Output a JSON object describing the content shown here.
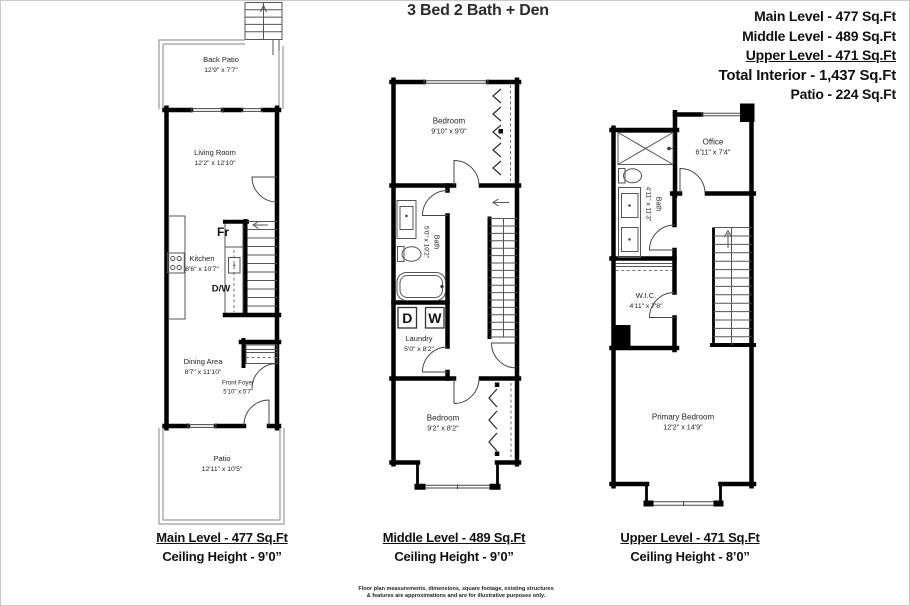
{
  "title": "3 Bed 2 Bath + Den",
  "summary": {
    "main": "Main Level - 477 Sq.Ft",
    "middle": "Middle Level - 489 Sq.Ft",
    "upper": "Upper Level - 471 Sq.Ft",
    "total": "Total Interior - 1,437 Sq.Ft",
    "patio": "Patio - 224 Sq.Ft"
  },
  "plans": {
    "main": {
      "caption": "Main Level - 477 Sq.Ft",
      "ceiling": "Ceiling Height - 9’0”",
      "rooms": {
        "back_patio": {
          "name": "Back Patio",
          "dims": "12'9\" x 7'7\""
        },
        "living_room": {
          "name": "Living Room",
          "dims": "12'2\" x 12'10\""
        },
        "kitchen": {
          "name": "Kitchen",
          "dims": "8'6\" x 10'7\""
        },
        "dining_area": {
          "name": "Dining Area",
          "dims": "8'7\" x 11'10\""
        },
        "front_foyer": {
          "name": "Front Foyer",
          "dims": "5'10\" x 5'7\""
        },
        "patio": {
          "name": "Patio",
          "dims": "12'11\" x 10'5\""
        }
      },
      "labels": {
        "fridge": "Fr",
        "dishwasher": "D/W"
      }
    },
    "middle": {
      "caption": "Middle Level - 489 Sq.Ft",
      "ceiling": "Ceiling Height - 9’0”",
      "rooms": {
        "bedroom_top": {
          "name": "Bedroom",
          "dims": "9'10\" x 9'0\""
        },
        "bath": {
          "name": "Bath",
          "dims": "5'0\" x 10'2\""
        },
        "laundry": {
          "name": "Laundry",
          "dims": "5'0\" x 8'2\""
        },
        "bedroom_bottom": {
          "name": "Bedroom",
          "dims": "9'2\" x 8'2\""
        }
      },
      "labels": {
        "dryer": "D",
        "washer": "W"
      }
    },
    "upper": {
      "caption": "Upper Level - 471 Sq.Ft",
      "ceiling": "Ceiling Height - 8’0”",
      "rooms": {
        "office": {
          "name": "Office",
          "dims": "6'11\" x 7'4\""
        },
        "bath": {
          "name": "Bath",
          "dims": "4'11\" x 11'3\""
        },
        "wic": {
          "name": "W.I.C.",
          "dims": "4'11\" x 7'8\""
        },
        "primary_bedroom": {
          "name": "Primary Bedroom",
          "dims": "12'2\" x 14'9\""
        }
      }
    }
  },
  "disclaimer": {
    "line1": "Floor plan measurements, dimensions, square footage, existing structures",
    "line2": "& features are approximations and are for illustrative purposes only."
  }
}
